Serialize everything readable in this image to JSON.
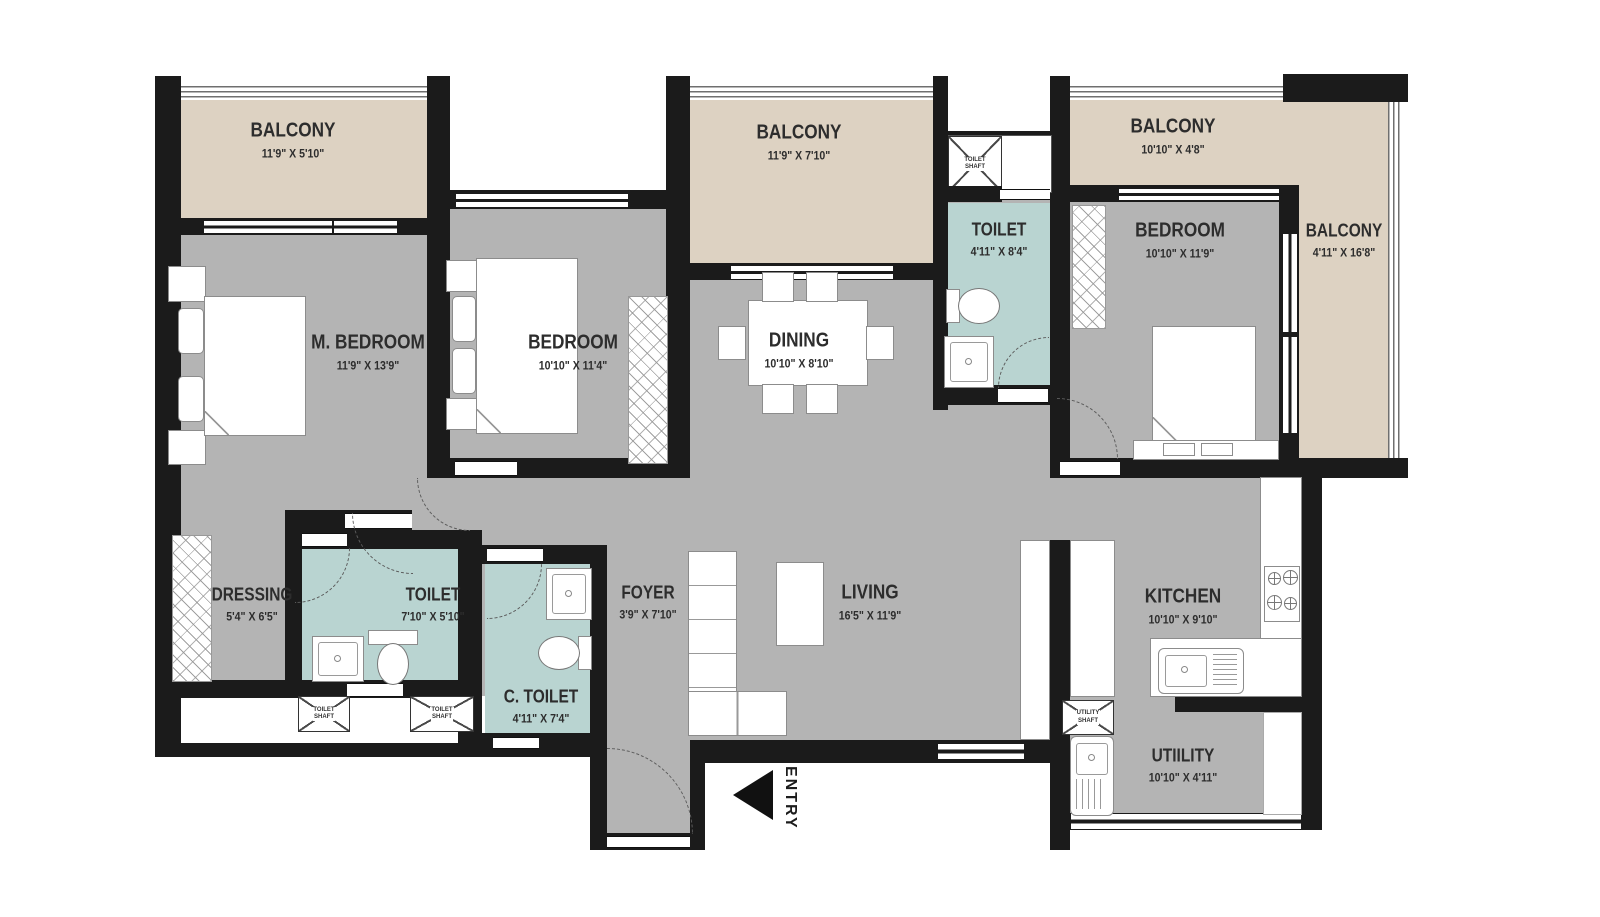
{
  "colors": {
    "wall": "#1b1b1b",
    "floor": "#b4b4b4",
    "balcony": "#ddd2c2",
    "wet_area": "#b9d4d1",
    "label_text": "#2d2d2d"
  },
  "rooms": [
    {
      "id": "balcony-top-left",
      "name": "BALCONY",
      "dims": "11'9\" X 5'10\""
    },
    {
      "id": "m-bedroom",
      "name": "M. BEDROOM",
      "dims": "11'9\" X 13'9\""
    },
    {
      "id": "bedroom-2",
      "name": "BEDROOM",
      "dims": "10'10\" X 11'4\""
    },
    {
      "id": "balcony-top-middle",
      "name": "BALCONY",
      "dims": "11'9\" X 7'10\""
    },
    {
      "id": "toilet-top",
      "name": "TOILET",
      "dims": "4'11\" X 8'4\""
    },
    {
      "id": "dining",
      "name": "DINING",
      "dims": "10'10\" X 8'10\""
    },
    {
      "id": "balcony-top-right",
      "name": "BALCONY",
      "dims": "10'10\" X 4'8\""
    },
    {
      "id": "bedroom-3",
      "name": "BEDROOM",
      "dims": "10'10\" X 11'9\""
    },
    {
      "id": "balcony-right",
      "name": "BALCONY",
      "dims": "4'11\" X 16'8\""
    },
    {
      "id": "dressing",
      "name": "DRESSING",
      "dims": "5'4\" X 6'5\""
    },
    {
      "id": "toilet-bottom",
      "name": "TOILET",
      "dims": "7'10\" X 5'10\""
    },
    {
      "id": "c-toilet",
      "name": "C. TOILET",
      "dims": "4'11\" X 7'4\""
    },
    {
      "id": "foyer",
      "name": "FOYER",
      "dims": "3'9\" X 7'10\""
    },
    {
      "id": "living",
      "name": "LIVING",
      "dims": "16'5\" X 11'9\""
    },
    {
      "id": "kitchen",
      "name": "KITCHEN",
      "dims": "10'10\" X 9'10\""
    },
    {
      "id": "utility",
      "name": "UTIILITY",
      "dims": "10'10\" X 4'11\""
    }
  ],
  "shafts": {
    "toilet": [
      "TOILET",
      "SHAFT"
    ],
    "utility": [
      "UTILITY",
      "SHAFT"
    ]
  },
  "entry": {
    "label": "ENTRY"
  }
}
